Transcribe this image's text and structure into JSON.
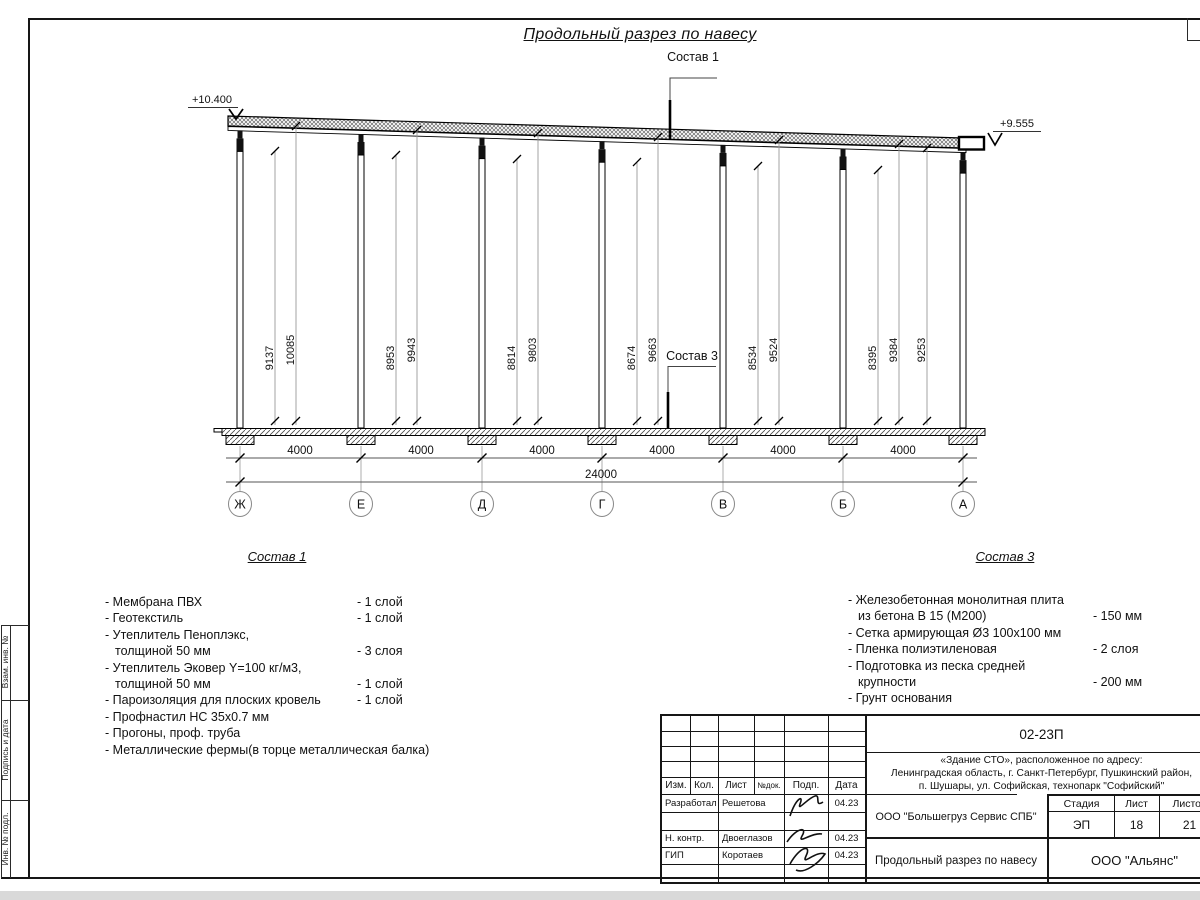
{
  "page": {
    "title": "Продольный разрез по навесу"
  },
  "drawing": {
    "callouts": {
      "sostav1": "Состав 1",
      "sostav3": "Состав 3"
    },
    "levels": {
      "left": "+10.400",
      "right": "+9.555"
    },
    "vertical_dims": [
      "9137",
      "10085",
      "8953",
      "9943",
      "8814",
      "9803",
      "8674",
      "9663",
      "8534",
      "9524",
      "8395",
      "9384",
      "9253"
    ],
    "bay_dims": [
      "4000",
      "4000",
      "4000",
      "4000",
      "4000",
      "4000"
    ],
    "total_dim": "24000",
    "grid_axes": [
      "Ж",
      "Е",
      "Д",
      "Г",
      "В",
      "Б",
      "А"
    ]
  },
  "sostav1": {
    "title": "Состав 1",
    "items": [
      {
        "text": "- Мембрана ПВХ",
        "amount": "- 1 слой"
      },
      {
        "text": "- Геотекстиль",
        "amount": "- 1 слой"
      },
      {
        "text": "- Утеплитель Пеноплэкс,",
        "amount": ""
      },
      {
        "text": "толщиной 50 мм",
        "amount": "- 3 слоя"
      },
      {
        "text": "- Утеплитель Эковер Y=100 кг/м3,",
        "amount": ""
      },
      {
        "text": "толщиной 50 мм",
        "amount": "- 1 слой"
      },
      {
        "text": "- Пароизоляция для плоских кровель",
        "amount": "- 1 слой"
      },
      {
        "text": "- Профнастил НС 35х0.7 мм",
        "amount": ""
      },
      {
        "text": "- Прогоны, проф. труба",
        "amount": ""
      },
      {
        "text": "- Металлические фермы(в торце металлическая балка)",
        "amount": ""
      }
    ]
  },
  "sostav3": {
    "title": "Состав 3",
    "items": [
      {
        "text": "- Железобетонная  монолитная плита",
        "amount": ""
      },
      {
        "text": "из бетона В 15 (М200)",
        "amount": "- 150 мм"
      },
      {
        "text": "- Сетка армирующая Ø3 100х100 мм",
        "amount": ""
      },
      {
        "text": "- Пленка полиэтиленовая",
        "amount": "-  2 слоя"
      },
      {
        "text": "- Подготовка из песка средней",
        "amount": ""
      },
      {
        "text": "крупности",
        "amount": "- 200 мм"
      },
      {
        "text": "- Грунт основания",
        "amount": ""
      }
    ]
  },
  "frame_stamp": {
    "side_labels": [
      "Взам. инв. №",
      "Подпись и дата",
      "Инв. № подл."
    ]
  },
  "title_block": {
    "doc_number": "02-23П",
    "address_lines": [
      "«Здание СТО», расположенное по адресу:",
      "Ленинградская область, г. Санкт-Петербург, Пушкинский район,",
      "п. Шушары, ул. Софийская, технопарк \"Софийский\""
    ],
    "columns": [
      "Изм.",
      "Кол.",
      "Лист",
      "№док.",
      "Подп.",
      "Дата"
    ],
    "rows": [
      {
        "role": "Разработал",
        "name": "Решетова",
        "date": "04.23"
      },
      {
        "role": "Н. контр.",
        "name": "Двоеглазов",
        "date": "04.23"
      },
      {
        "role": "ГИП",
        "name": "Коротаев",
        "date": "04.23"
      }
    ],
    "company": "ООО \"Большегруз Сервис СПБ\"",
    "stage_label": "Стадия",
    "sheet_label": "Лист",
    "sheets_label": "Листов",
    "stage": "ЭП",
    "sheet": "18",
    "sheets": "21",
    "drawing_name": "Продольный разрез по навесу",
    "org": "ООО \"Альянс\""
  }
}
